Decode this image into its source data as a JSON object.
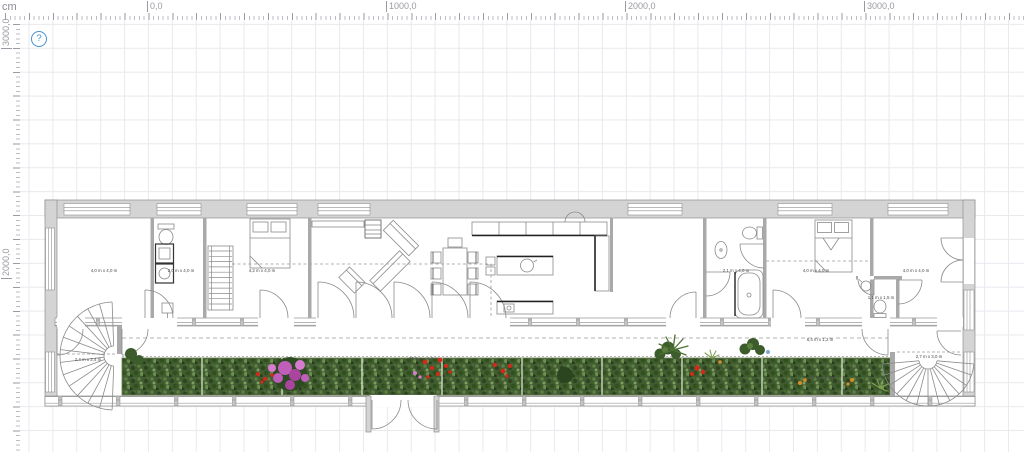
{
  "ruler": {
    "unit": "cm",
    "top_labels": [
      "0,0",
      "1000,0",
      "2000,0",
      "3000,0"
    ],
    "left_labels": [
      "3000,0",
      "2000,0"
    ]
  },
  "help_button": {
    "glyph": "?"
  },
  "plan": {
    "room_labels": {
      "bedroom_left": "4,0 m x 4,0 m",
      "utility": "2,0 m x 4,0 m",
      "bedroom_mid": "4,2 m x 4,0 m",
      "bathroom": "2,1 m x 4,0 m",
      "bedroom_right": "4,0 m x 4,0 m",
      "bedroom_far_right": "4,0 m x 4,0 m",
      "wc": "1,1 m x 1,5 m",
      "spiral_stair_left": "2,4 m x 2,4 m",
      "spiral_stair_right": "2,7 m x 3,0 m",
      "planter_long": "25,8 m x 1,2 m",
      "terrace_right": "6,4 m x 1,2 m",
      "planter_right": "6,4 m x 1,2 m"
    },
    "colors": {
      "wall_fill": "#d4d4d4",
      "wall_stroke": "#8f8f8f",
      "line": "#6e6e6e",
      "dashed": "#9a9a9a",
      "foliage_base": "#415c33",
      "flower_magenta": "#c05fba",
      "flower_red": "#cf2a1a",
      "flower_orange": "#d98a2b",
      "flower_blue": "#7ba7d9",
      "help_blue": "#4a90d2",
      "grid": "#e9e9ee"
    }
  }
}
